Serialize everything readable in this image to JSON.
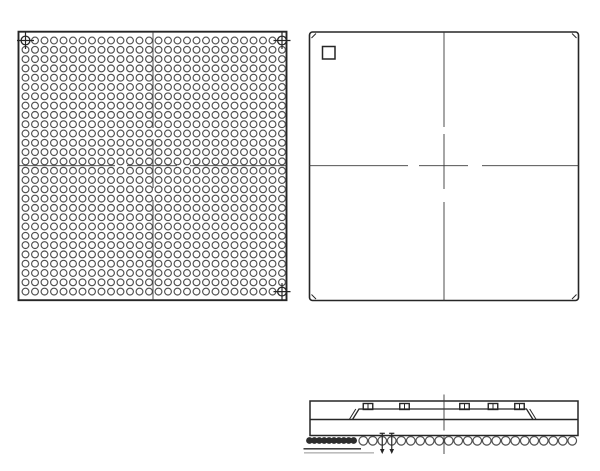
{
  "drawing": {
    "description": "BGA package outline drawing: bottom ball-grid view, top view with pin-1 marker, side profile view",
    "colors": {
      "background": "#ffffff",
      "line": "#262626",
      "ball": "#4f4f4f",
      "hatch": "#2d2d2d",
      "centerline": "#3a3a3a",
      "faint": "#bdbdbd"
    },
    "bottom_view": {
      "pkg": [
        18.5,
        31.7,
        268,
        268.5
      ],
      "grid": {
        "cols": 28,
        "rows": 28,
        "x0": 25.5,
        "y0": 40.5,
        "px": 9.5,
        "py": 9.3,
        "r": 3.4
      },
      "fiducials": [
        [
          0,
          0
        ],
        [
          27,
          0
        ],
        [
          27,
          27
        ]
      ],
      "fiducial_r": 4.4,
      "fiducial_arm": 8.5,
      "cl_v": {
        "x": 153.0,
        "segs": [
          [
            31.7,
            128
          ],
          [
            139,
            188
          ],
          [
            200,
            300.2
          ]
        ]
      },
      "cl_h": {
        "y": 165.7,
        "segs": [
          [
            18.5,
            115
          ],
          [
            127,
            177
          ],
          [
            190,
            286.8
          ]
        ]
      }
    },
    "top_view": {
      "pkg": [
        309.5,
        32,
        269,
        268.5
      ],
      "corner_radius": 3,
      "pin1": [
        322.5,
        46.5,
        12.5,
        12.5
      ],
      "corner_ticks": [
        [
          311.5,
          38,
          316,
          33.5
        ],
        [
          572,
          33.5,
          576.5,
          38
        ],
        [
          311.5,
          294.5,
          316,
          299
        ],
        [
          572,
          299,
          576.5,
          294.5
        ]
      ],
      "cl_v": {
        "x": 444,
        "segs": [
          [
            32,
            127
          ],
          [
            134,
            189
          ],
          [
            202,
            300.5
          ]
        ]
      },
      "cl_h": {
        "y": 165.7,
        "segs": [
          [
            309.5,
            408
          ],
          [
            419,
            468
          ],
          [
            482,
            578.5
          ]
        ]
      }
    },
    "side_view": {
      "body": [
        310,
        401,
        268,
        34.5
      ],
      "divider_y": 419.5,
      "lid": {
        "top_y": 409,
        "base_y": 419.5,
        "x1": 359,
        "x2": 526.5,
        "foot": 6.5,
        "double_off": 3.2
      },
      "caps": {
        "y": 403.5,
        "h": 6,
        "w": 9.5,
        "centers": [
          368,
          404.5,
          464.5,
          493,
          519.5
        ]
      },
      "balls": {
        "n": 28,
        "x0": 315.75,
        "pitch": 9.5,
        "cy": 440.8,
        "r": 4.3,
        "open_from": 5
      },
      "arrows": [
        382.25,
        391.75
      ],
      "hatch_balls": {
        "x0": 309.5,
        "n": 10,
        "pitch": 4.9,
        "cy": 440.5,
        "r": 2.9
      },
      "seat_line": [
        303.5,
        448.8,
        361,
        448.8
      ],
      "faint_line": [
        304,
        452.8,
        374,
        452.8
      ],
      "cl_v": {
        "x": 444,
        "segs": [
          [
            394.5,
            430.5
          ],
          [
            435.5,
            454
          ]
        ]
      }
    }
  }
}
